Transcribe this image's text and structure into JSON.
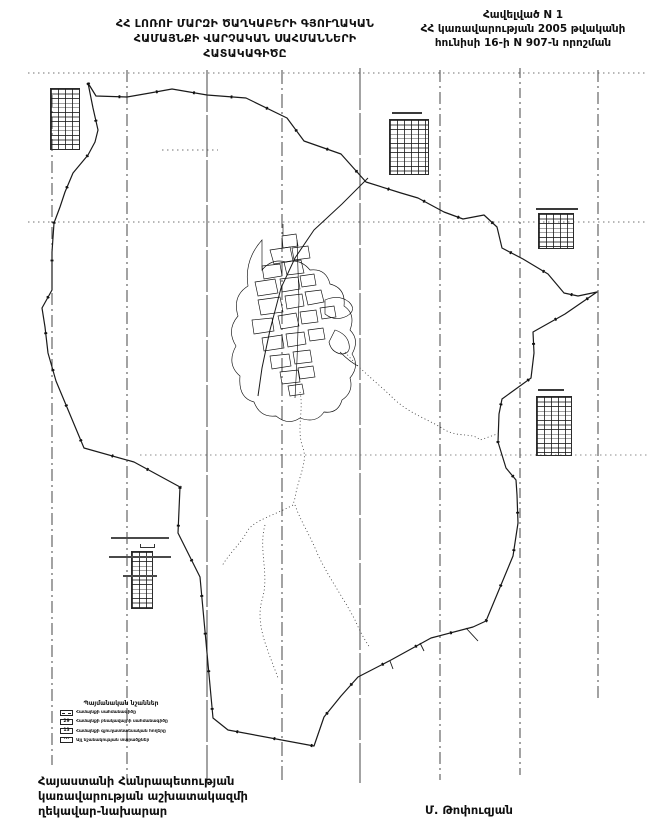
{
  "header": {
    "title": [
      "ՀՀ ԼՈՌՈՒ ՄԱՐԶԻ ԾԱՂԿԱԲԵՐԻ ԳՅՈՒՂԱԿԱՆ",
      "ՀԱՄԱՅՆՔԻ ՎԱՐՉԱԿԱՆ ՍԱՀՄԱՆՆԵՐԻ",
      "ՀԱՏԱԿԱԳԻԾԸ"
    ],
    "annex": [
      "Հավելված N 1",
      "ՀՀ կառավարության 2005 թվականի",
      "հունիսի 16-ի N 907-ն որոշման"
    ]
  },
  "map": {
    "legend": {
      "title": "Պայմանական նշաններ",
      "items": [
        {
          "symbol": "",
          "label": "Համայնքի սահմանագիծը"
        },
        {
          "symbol": "29",
          "label": "Համայնքի բնակավայրի սահմանագիծը"
        },
        {
          "symbol": "13",
          "label": "Համայնքի գյուղատնտեսական հողերը"
        },
        {
          "symbol": "···",
          "label": "Այլ նշանակության տարածքներ"
        }
      ]
    }
  },
  "footer": {
    "official": [
      "Հայաստանի Հանրապետության",
      "կառավարության աշխատակազմի",
      "ղեկավար-նախարար"
    ],
    "signature": "Մ. Թոփուզյան"
  },
  "colors": {
    "ink": "#1a1a1a",
    "paper": "#ffffff"
  }
}
